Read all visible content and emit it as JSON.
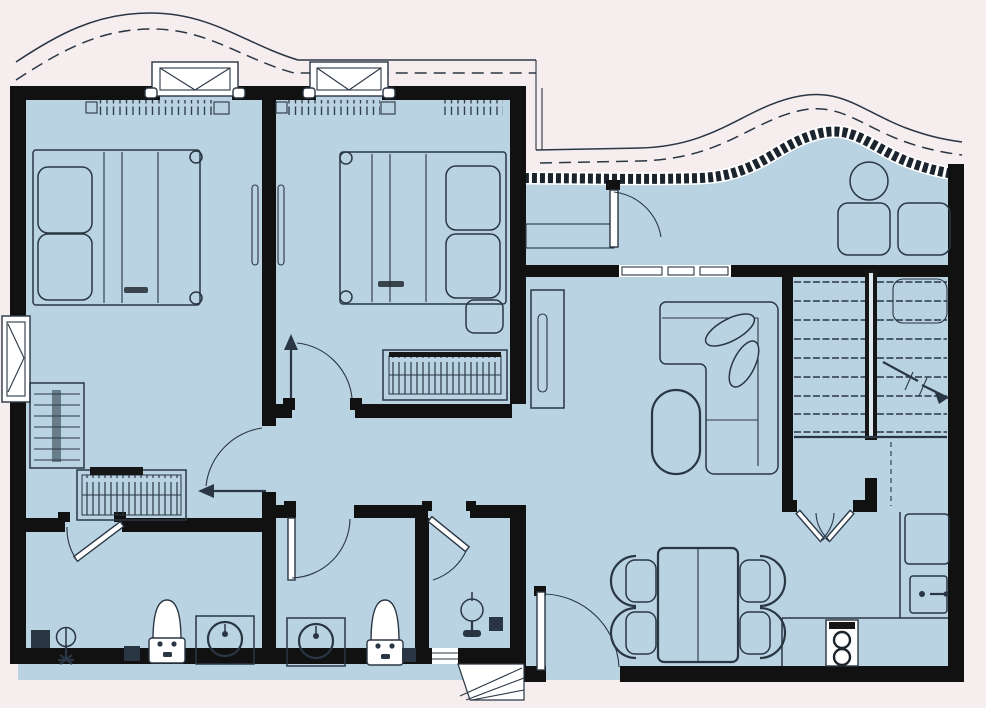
{
  "palette": {
    "background": "#f6edee",
    "floor": "#b9d3e2",
    "wall": "#111111",
    "line": "#2a3644",
    "white": "#ffffff"
  },
  "plan": {
    "type": "apartment-floor-plan",
    "text_labels": [],
    "rooms": [
      {
        "id": "bedroom-1",
        "furniture": [
          "double-bed",
          "pillows",
          "wardrobe-tall",
          "wardrobe-low",
          "radiator"
        ]
      },
      {
        "id": "bedroom-2",
        "furniture": [
          "double-bed",
          "pillows",
          "nightstand",
          "dresser",
          "radiator"
        ]
      },
      {
        "id": "ensuite-bathroom",
        "furniture": [
          "toilet",
          "washbasin",
          "shower",
          "floor-drain",
          "floor-drain"
        ]
      },
      {
        "id": "bathroom",
        "furniture": [
          "toilet",
          "washbasin",
          "floor-drain"
        ]
      },
      {
        "id": "wc",
        "furniture": [
          "pedestal-basin",
          "floor-drain",
          "window"
        ]
      },
      {
        "id": "hallway",
        "furniture": []
      },
      {
        "id": "sun-lounge",
        "furniture": [
          "round-table",
          "chair",
          "chair",
          "bench",
          "door"
        ]
      },
      {
        "id": "living-room",
        "furniture": [
          "l-sofa",
          "cushions",
          "coffee-table",
          "sideboard"
        ]
      },
      {
        "id": "staircase",
        "furniture": [
          "treads",
          "center-wall",
          "direction-arrow",
          "landing"
        ]
      },
      {
        "id": "kitchen-dining",
        "furniture": [
          "dining-table",
          "chair",
          "chair",
          "chair",
          "chair",
          "counter",
          "stove",
          "sink",
          "fridge",
          "double-swing-door",
          "entry-door"
        ]
      },
      {
        "id": "balcony",
        "furniture": [
          "railing-curve"
        ]
      },
      {
        "id": "terrace",
        "furniture": [
          "parapet-hatched"
        ]
      },
      {
        "id": "entry-steps",
        "furniture": [
          "steps"
        ]
      }
    ]
  }
}
